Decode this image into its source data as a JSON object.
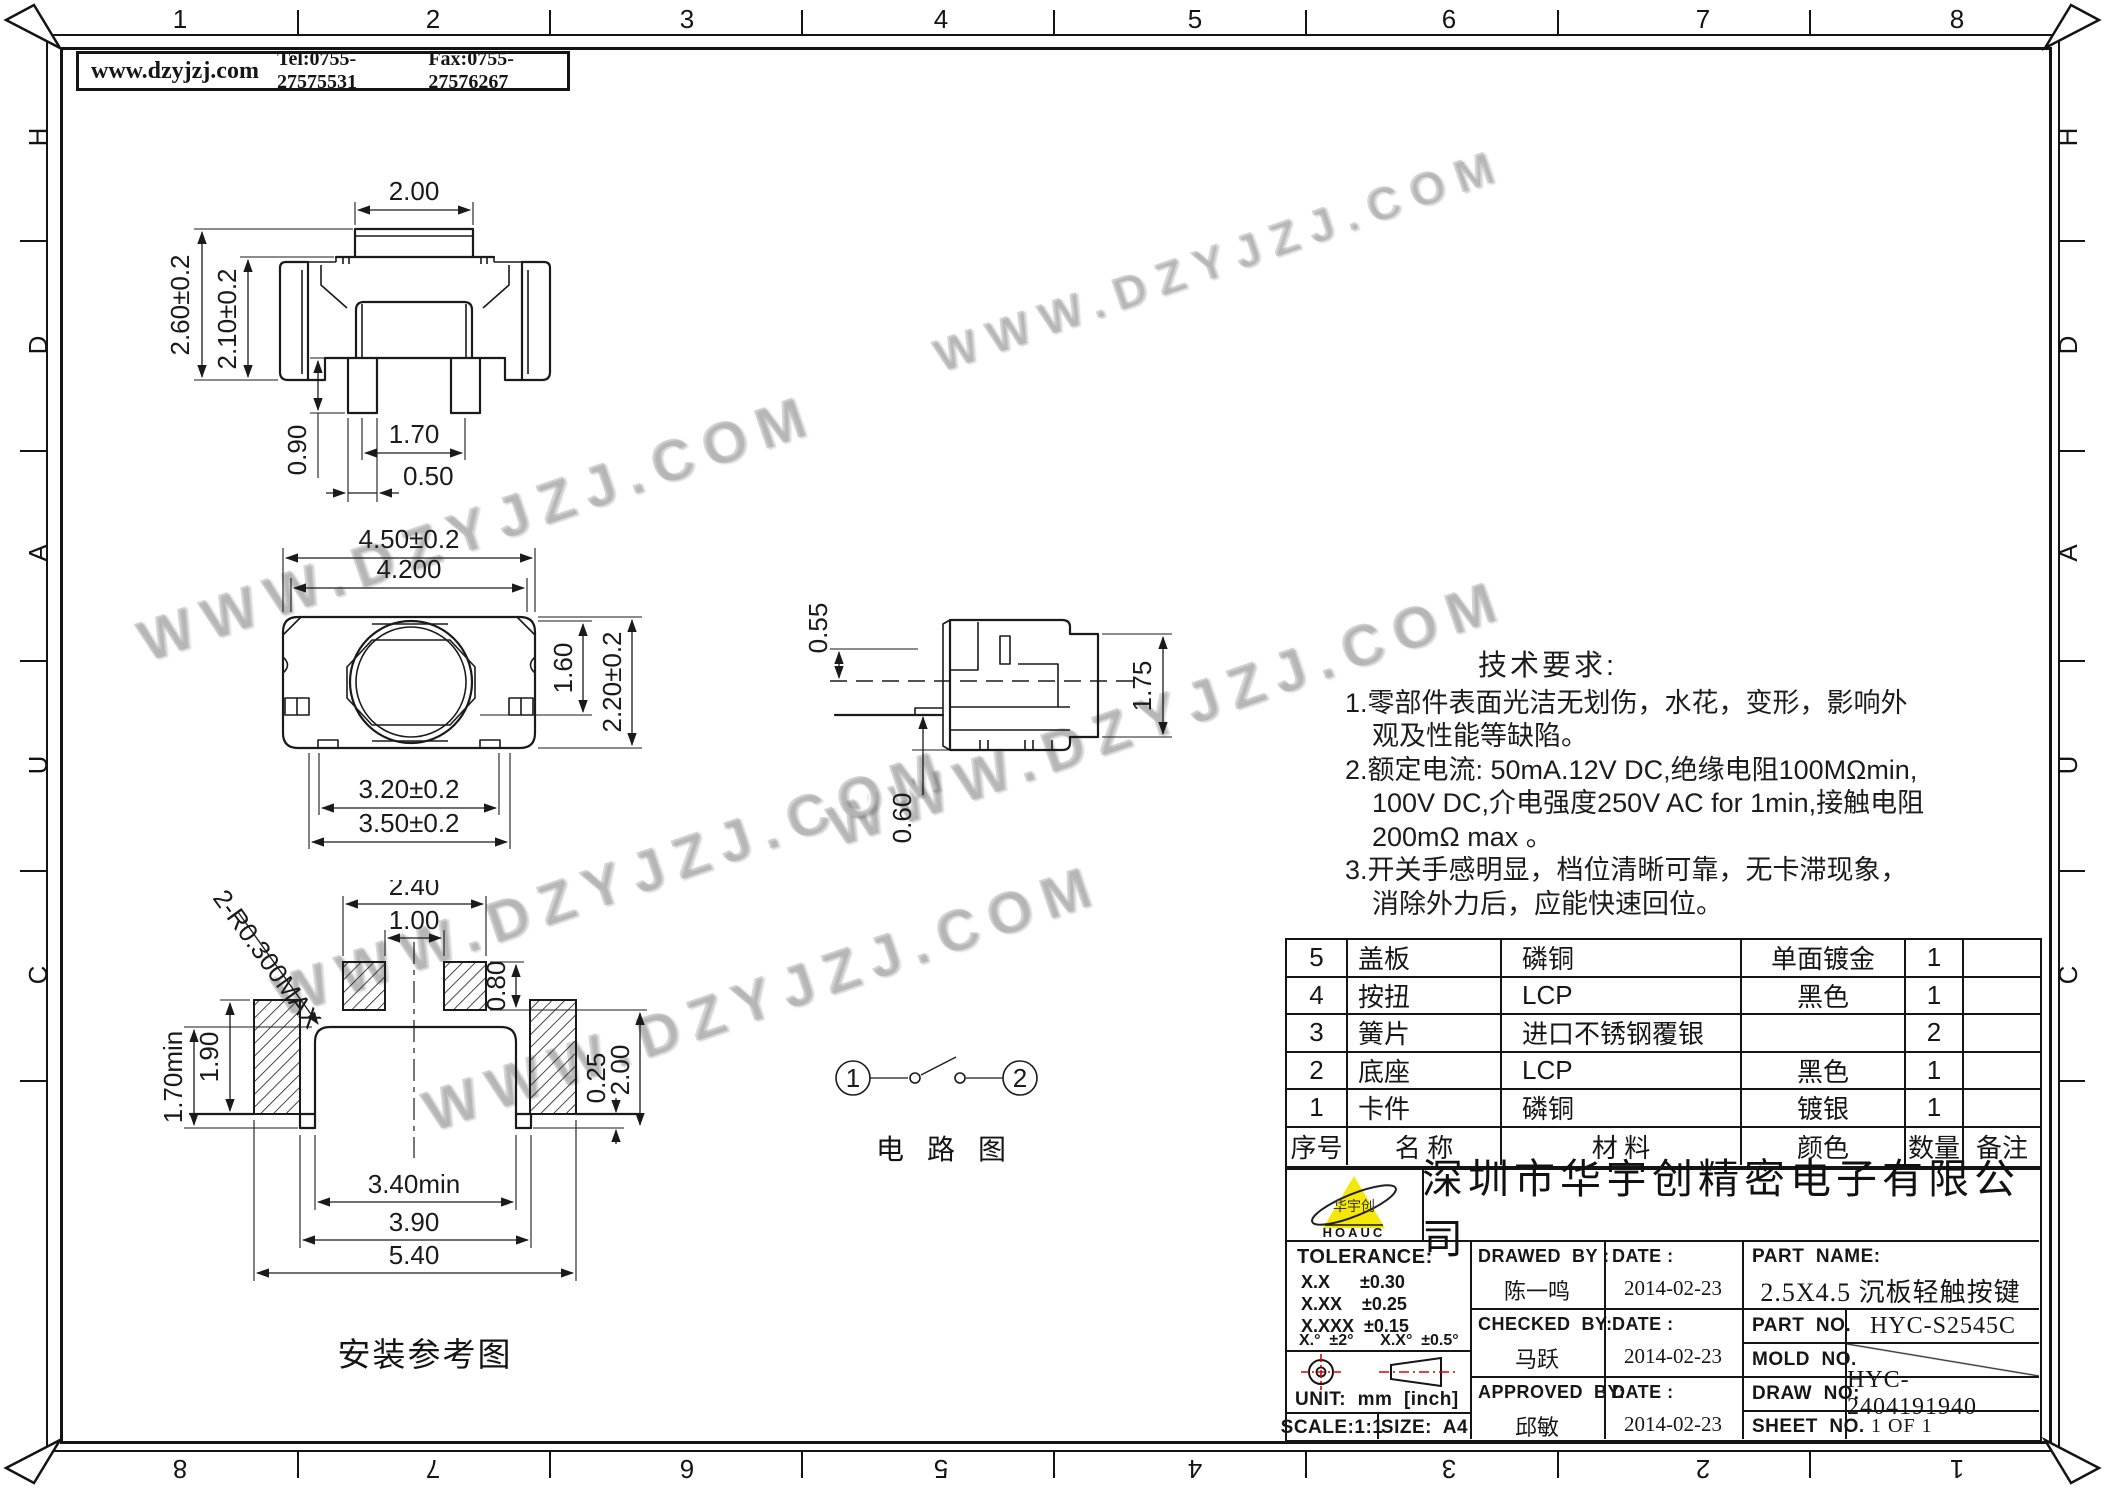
{
  "header": {
    "website": "www.dzyjzj.com",
    "tel": "Tel:0755-27575531",
    "fax": "Fax:0755-27576267"
  },
  "frame": {
    "top": [
      "1",
      "2",
      "3",
      "4",
      "5",
      "6",
      "7",
      "8"
    ],
    "bottom": [
      "8",
      "7",
      "6",
      "5",
      "4",
      "3",
      "2",
      "1"
    ],
    "left": [
      "H",
      "D",
      "A",
      "U",
      "C"
    ],
    "right": [
      "H",
      "D",
      "A",
      "U",
      "C"
    ]
  },
  "watermark": "WWW.DZYJZJ.COM",
  "front_view": {
    "dim_button_width": "2.00",
    "dim_total_height": "2.60±0.2",
    "dim_body_height": "2.10±0.2",
    "dim_pin_length": "0.90",
    "dim_pin_pitch": "1.70",
    "dim_pin_width": "0.50"
  },
  "top_view": {
    "dim_total_width": "4.50±0.2",
    "dim_inner_width": "4.200",
    "dim_button": "1.60",
    "dim_depth": "2.20±0.2",
    "dim_base_inner": "3.20±0.2",
    "dim_base_outer": "3.50±0.2"
  },
  "side_view": {
    "dim_top": "0.55",
    "dim_height": "1.75",
    "dim_bottom": "0.60"
  },
  "mount_view": {
    "caption": "安装参考图",
    "radius_note": "2-R0.300MAX",
    "dim_pad_span": "2.40",
    "dim_pad_gap": "1.00",
    "dim_pad_height": "0.80",
    "dim_side_pad": "1.90",
    "dim_side_min": "1.70min",
    "dim_step": "0.25",
    "dim_side_height": "2.00",
    "dim_opening": "3.40min",
    "dim_inner_width": "3.90",
    "dim_outer_width": "5.40"
  },
  "circuit": {
    "caption": "电 路 图",
    "terminal_1": "1",
    "terminal_2": "2"
  },
  "tech_requirements": {
    "title": "技术要求:",
    "lines": [
      "1.零部件表面光洁无划伤，水花，变形，影响外",
      "观及性能等缺陷。",
      "2.额定电流: 50mA.12V DC,绝缘电阻100MΩmin,",
      "100V DC,介电强度250V AC for 1min,接触电阻",
      "200mΩ max 。",
      "3.开关手感明显，档位清晰可靠，无卡滞现象，",
      "消除外力后，应能快速回位。"
    ]
  },
  "parts_table": {
    "rows": [
      {
        "no": "5",
        "name": "盖板",
        "material": "磷铜",
        "color": "单面镀金",
        "qty": "1",
        "note": ""
      },
      {
        "no": "4",
        "name": "按扭",
        "material": "LCP",
        "color": "黑色",
        "qty": "1",
        "note": ""
      },
      {
        "no": "3",
        "name": "簧片",
        "material": "进口不锈钢覆银",
        "color": "",
        "qty": "2",
        "note": ""
      },
      {
        "no": "2",
        "name": "底座",
        "material": "LCP",
        "color": "黑色",
        "qty": "1",
        "note": ""
      },
      {
        "no": "1",
        "name": "卡件",
        "material": "磷铜",
        "color": "镀银",
        "qty": "1",
        "note": ""
      }
    ],
    "header": {
      "no": "序号",
      "name": "名  称",
      "material": "材  料",
      "color": "颜色",
      "qty": "数量",
      "note": "备注"
    }
  },
  "title_block": {
    "company": "深圳市华宇创精密电子有限公司",
    "logo_text": "华宇创",
    "logo_sub": "HOAUC",
    "tolerance_label": "TOLERANCE:",
    "tol_line1": "X.X      ±0.30",
    "tol_line2": "X.XX    ±0.25",
    "tol_line3": "X.XXX  ±0.15",
    "tol_angle": "X.°  ±2°      X.X°  ±0.5°",
    "unit_label": "UNIT:  mm  [inch]",
    "scale_label": "SCALE:1:1",
    "size_label": "SIZE:  A4",
    "drawed_by_label": "DRAWED  BY :",
    "drawed_by": "陈一鸣",
    "checked_by_label": "CHECKED  BY:",
    "checked_by": "马跃",
    "approved_by_label": "APPROVED  BY:",
    "approved_by": "邱敏",
    "date_label": "DATE :",
    "date_drawed": "2014-02-23",
    "date_checked": "2014-02-23",
    "date_approved": "2014-02-23",
    "part_name_label": "PART  NAME:",
    "part_name": "2.5X4.5 沉板轻触按键",
    "part_no_label": "PART  NO.",
    "part_no": "HYC-S2545C",
    "mold_no_label": "MOLD  NO.",
    "draw_no_label": "DRAW  NO:",
    "draw_no": "HYC-2404191940",
    "sheet_no_label": "SHEET  NO.",
    "sheet_no": "1 OF 1"
  },
  "colors": {
    "line": "#1a1a1a",
    "logo_yellow": "#f6e70a",
    "symbol_red": "#e00000",
    "watermark_gray": "#7d7d7d"
  }
}
